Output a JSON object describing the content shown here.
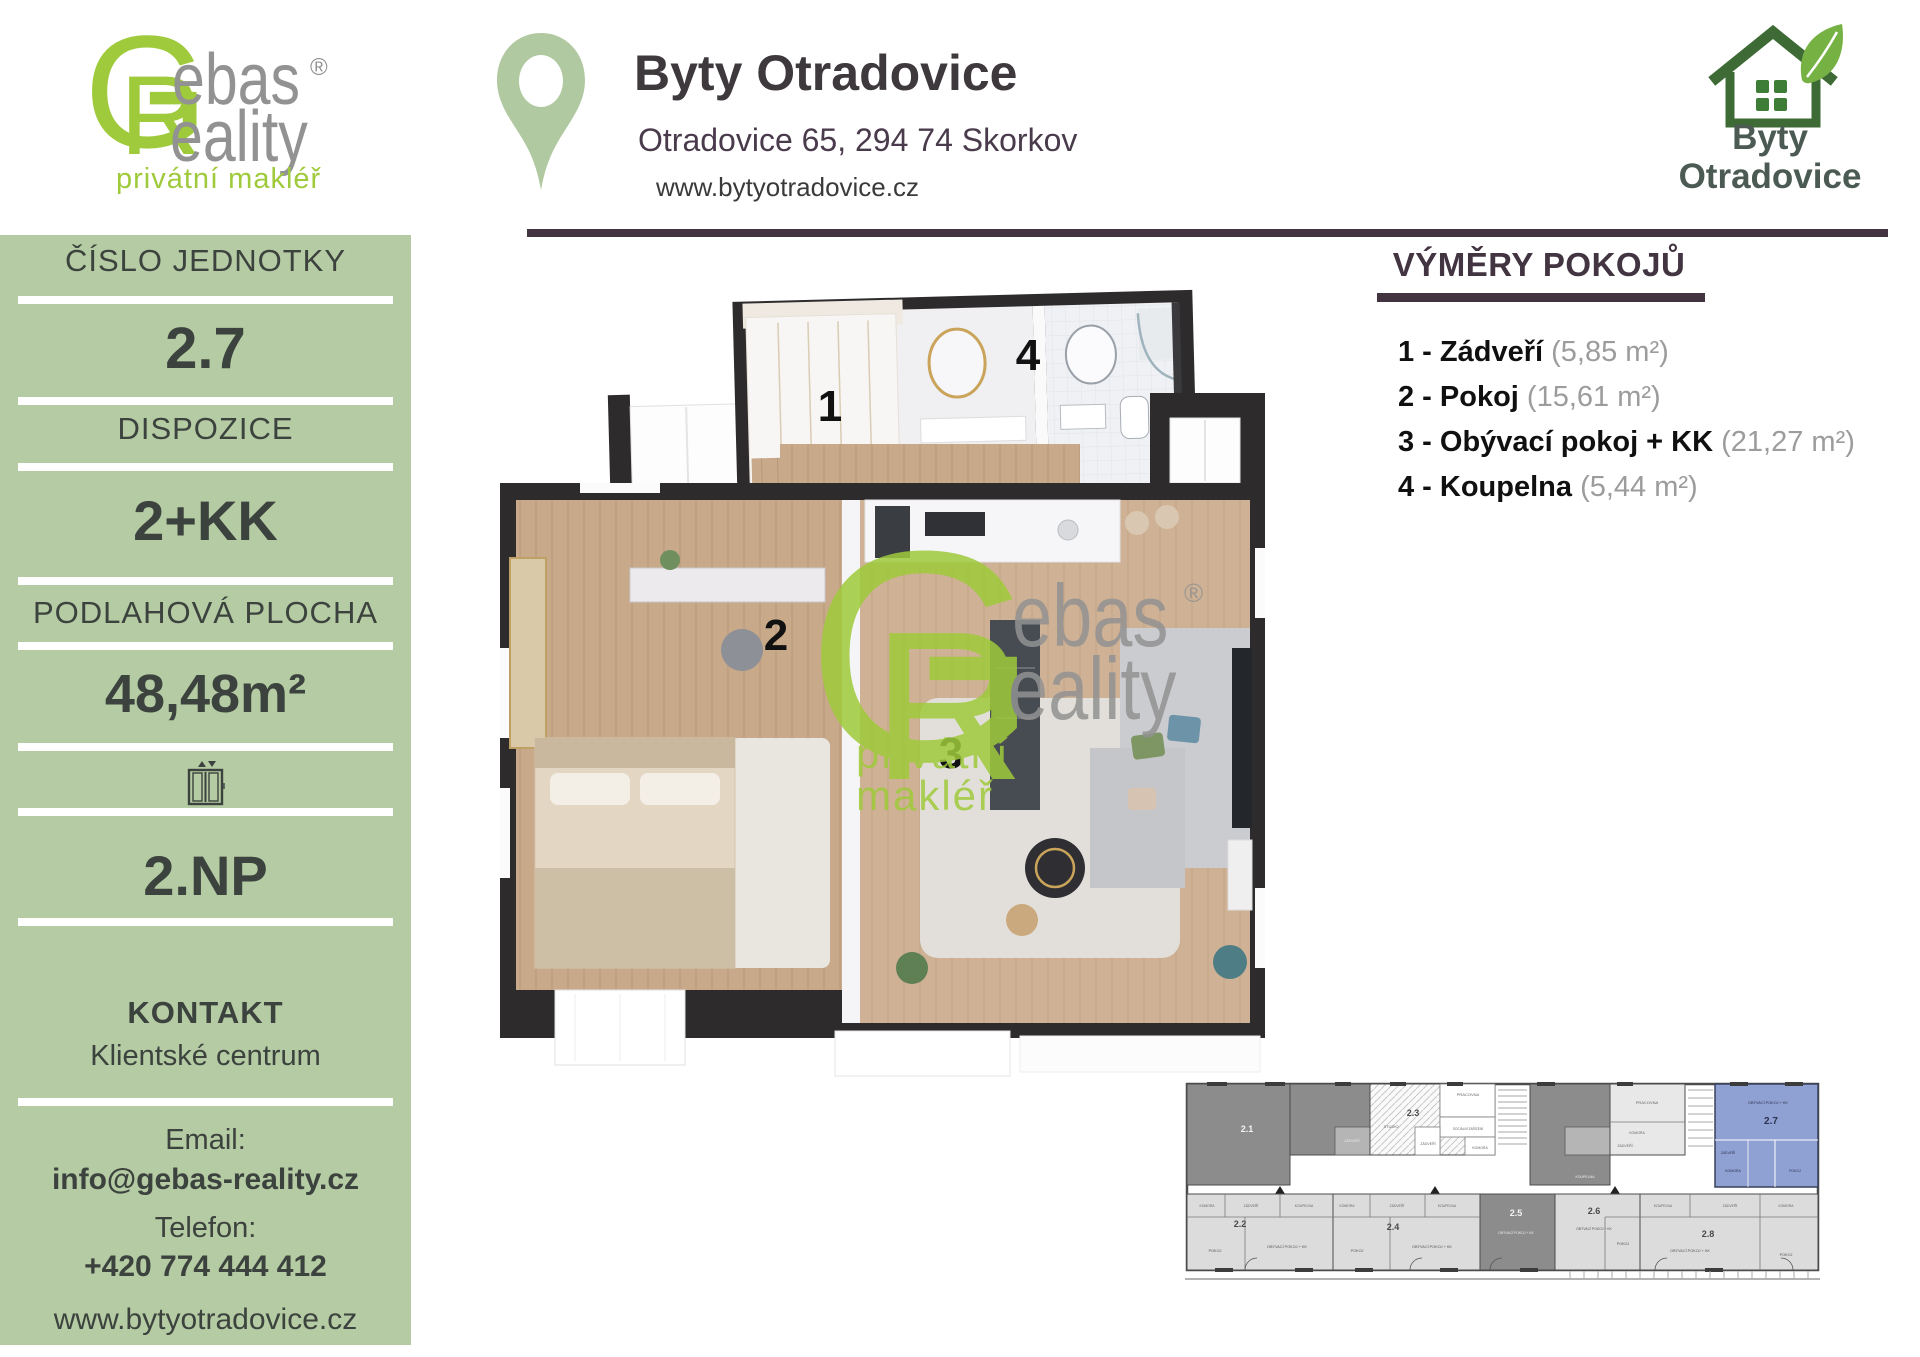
{
  "brand": {
    "gebas": {
      "g": "G",
      "r": "R",
      "ebas": "ebas",
      "eality": "eality",
      "reg": "®",
      "tagline": "privátní makléř"
    },
    "byty_logo": {
      "line1": "Byty",
      "line2": "Otradovice"
    }
  },
  "header": {
    "title": "Byty Otradovice",
    "address": "Otradovice 65, 294 74 Skorkov",
    "website": "www.bytyotradovice.cz"
  },
  "sidebar": {
    "unit_number_label": "ČÍSLO JEDNOTKY",
    "unit_number": "2.7",
    "layout_label": "DISPOZICE",
    "layout": "2+KK",
    "area_label": "PODLAHOVÁ PLOCHA",
    "area": "48,48m²",
    "floor": "2.NP",
    "contact_label": "KONTAKT",
    "contact_name": "Klientské centrum",
    "email_label": "Email:",
    "email": "info@gebas-reality.cz",
    "phone_label": "Telefon:",
    "phone": "+420 774 444 412",
    "website": "www.bytyotradovice.cz"
  },
  "rooms_panel": {
    "title": "VÝMĚRY POKOJŮ",
    "items": [
      {
        "name": "1 - Zádveří",
        "area": "(5,85 m²)"
      },
      {
        "name": "2 - Pokoj",
        "area": "(15,61 m²)"
      },
      {
        "name": "3 - Obývací pokoj + KK",
        "area": "(21,27 m²)"
      },
      {
        "name": "4 - Koupelna",
        "area": "(5,44 m²)"
      }
    ]
  },
  "floorplan": {
    "rooms": [
      {
        "n": "1",
        "x": 830,
        "y": 407
      },
      {
        "n": "2",
        "x": 776,
        "y": 636
      },
      {
        "n": "3",
        "x": 951,
        "y": 754
      },
      {
        "n": "4",
        "x": 1028,
        "y": 356
      }
    ]
  },
  "miniplan": {
    "highlighted_unit": "2.7",
    "labels": [
      {
        "t": "2.1",
        "x": 62,
        "y": 50,
        "s": 9,
        "c": "#f2f2f2",
        "w": 700
      },
      {
        "t": "ZÁDVEŘÍ",
        "x": 167,
        "y": 60,
        "s": 3.6,
        "c": "#e8e8e8"
      },
      {
        "t": "2.3",
        "x": 228,
        "y": 34,
        "s": 9,
        "c": "#4a4a4a",
        "w": 700
      },
      {
        "t": "STUDIO",
        "x": 206,
        "y": 46,
        "s": 4,
        "c": "#666"
      },
      {
        "t": "PRACOVNA",
        "x": 283,
        "y": 14,
        "s": 4,
        "c": "#666"
      },
      {
        "t": "SOCIÁLNÍ ZAŘÍZENÍ",
        "x": 283,
        "y": 48,
        "s": 3.2,
        "c": "#666"
      },
      {
        "t": "ZÁDVEŘÍ",
        "x": 243,
        "y": 63,
        "s": 3.5,
        "c": "#666"
      },
      {
        "t": "KOMORA",
        "x": 295,
        "y": 67,
        "s": 3.5,
        "c": "#666"
      },
      {
        "t": "KOUPELNA",
        "x": 400,
        "y": 96,
        "s": 3.5,
        "c": "#eee"
      },
      {
        "t": "PRACOVNA",
        "x": 462,
        "y": 22,
        "s": 4,
        "c": "#666"
      },
      {
        "t": "KOMORA",
        "x": 452,
        "y": 52,
        "s": 3.5,
        "c": "#666"
      },
      {
        "t": "ZÁDVEŘÍ",
        "x": 440,
        "y": 65,
        "s": 3.5,
        "c": "#666"
      },
      {
        "t": "OBÝVACÍ POKOJ + KK",
        "x": 583,
        "y": 22,
        "s": 3.8,
        "c": "#2c3350"
      },
      {
        "t": "2.7",
        "x": 586,
        "y": 42,
        "s": 10,
        "c": "#2c3350",
        "w": 700
      },
      {
        "t": "ZÁDVEŘÍ",
        "x": 543,
        "y": 72,
        "s": 3.3,
        "c": "#2c3350"
      },
      {
        "t": "KOMORA",
        "x": 548,
        "y": 90,
        "s": 3.5,
        "c": "#2c3350"
      },
      {
        "t": "POKOJ",
        "x": 610,
        "y": 90,
        "s": 3.5,
        "c": "#2c3350"
      },
      {
        "t": "KOMORA",
        "x": 22,
        "y": 125,
        "s": 3.4,
        "c": "#666"
      },
      {
        "t": "ZÁDVEŘÍ",
        "x": 66,
        "y": 125,
        "s": 3.4,
        "c": "#666"
      },
      {
        "t": "KOUPELNA",
        "x": 119,
        "y": 125,
        "s": 3.4,
        "c": "#666"
      },
      {
        "t": "2.2",
        "x": 55,
        "y": 145,
        "s": 9,
        "c": "#4a4a4a",
        "w": 700
      },
      {
        "t": "POKOJ",
        "x": 30,
        "y": 170,
        "s": 3.8,
        "c": "#555"
      },
      {
        "t": "OBÝVACÍ POKOJ + KK",
        "x": 102,
        "y": 166,
        "s": 3.8,
        "c": "#555"
      },
      {
        "t": "KOMORA",
        "x": 162,
        "y": 125,
        "s": 3.4,
        "c": "#666"
      },
      {
        "t": "ZÁDVEŘÍ",
        "x": 212,
        "y": 125,
        "s": 3.4,
        "c": "#666"
      },
      {
        "t": "KOUPELNA",
        "x": 262,
        "y": 125,
        "s": 3.4,
        "c": "#666"
      },
      {
        "t": "2.4",
        "x": 208,
        "y": 148,
        "s": 9,
        "c": "#4a4a4a",
        "w": 700
      },
      {
        "t": "POKOJ",
        "x": 172,
        "y": 170,
        "s": 3.8,
        "c": "#555"
      },
      {
        "t": "OBÝVACÍ POKOJ + KK",
        "x": 247,
        "y": 166,
        "s": 3.8,
        "c": "#555"
      },
      {
        "t": "2.5",
        "x": 331,
        "y": 134,
        "s": 9,
        "c": "#f2f2f2",
        "w": 700
      },
      {
        "t": "OBÝVACÍ POKOJ + KK",
        "x": 331,
        "y": 152,
        "s": 3.4,
        "c": "#eee"
      },
      {
        "t": "2.6",
        "x": 409,
        "y": 132,
        "s": 9,
        "c": "#4a4a4a",
        "w": 700
      },
      {
        "t": "OBÝVACÍ POKOJ + KK",
        "x": 409,
        "y": 148,
        "s": 3.4,
        "c": "#555"
      },
      {
        "t": "POKOJ",
        "x": 438,
        "y": 163,
        "s": 3.6,
        "c": "#555"
      },
      {
        "t": "KOUPELNA",
        "x": 478,
        "y": 125,
        "s": 3.4,
        "c": "#666"
      },
      {
        "t": "ZÁDVEŘÍ",
        "x": 545,
        "y": 125,
        "s": 3.4,
        "c": "#666"
      },
      {
        "t": "KOMORA",
        "x": 601,
        "y": 125,
        "s": 3.4,
        "c": "#666"
      },
      {
        "t": "2.8",
        "x": 523,
        "y": 155,
        "s": 9,
        "c": "#4a4a4a",
        "w": 700
      },
      {
        "t": "OBÝVACÍ POKOJ + KK",
        "x": 505,
        "y": 170,
        "s": 3.8,
        "c": "#555"
      },
      {
        "t": "POKOJ",
        "x": 601,
        "y": 174,
        "s": 3.8,
        "c": "#555"
      }
    ]
  },
  "colors": {
    "sidebar_green": "#b4cba3",
    "logo_green": "#9fca3b",
    "dark_purple": "#423441",
    "text_dark": "#3c423d",
    "unit_highlight_blue": "#8fa0d2",
    "house_green": "#3e6b35",
    "leaf_green": "#76b144"
  }
}
